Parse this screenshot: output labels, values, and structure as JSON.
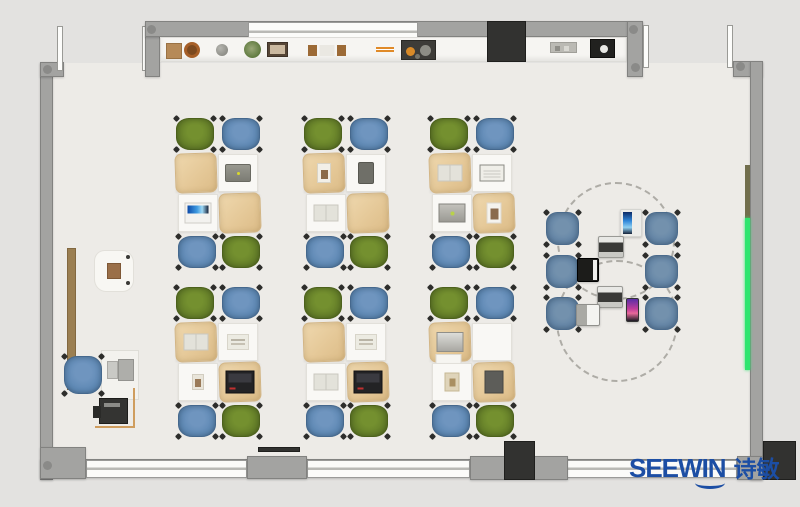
{
  "brand": {
    "name": "SEEWIN",
    "cjk": "诗敏",
    "color": "#1c4ea4"
  },
  "palette": {
    "floor": "#edebe7",
    "outside": "#e3e2e0",
    "wall": "#a3a3a1",
    "window": "#fbfbf9",
    "chair_green": "#637d28",
    "chair_blue": "#5c87b3",
    "chair_steel": "#6183a5",
    "desk_cover_tan": "#e8cfa2",
    "board_green": "#2fe56f",
    "board_olive": "#716e4c"
  },
  "clusters": [
    {
      "id": "row1-col1",
      "x": 176,
      "y": 118,
      "chairs": [
        "green",
        "blue",
        "blue",
        "green"
      ],
      "desks": [
        {
          "cover": "tan",
          "item": "none"
        },
        {
          "cover": "white",
          "item": "tablet-gray"
        },
        {
          "cover": "white",
          "item": "laptop-blue"
        },
        {
          "cover": "tan",
          "item": "none"
        }
      ]
    },
    {
      "id": "row1-col2",
      "x": 304,
      "y": 118,
      "chairs": [
        "green",
        "blue",
        "blue",
        "green"
      ],
      "desks": [
        {
          "cover": "tan",
          "item": "book-white"
        },
        {
          "cover": "white",
          "item": "tablet-dark"
        },
        {
          "cover": "white",
          "item": "open-book"
        },
        {
          "cover": "tan",
          "item": "none"
        }
      ]
    },
    {
      "id": "row1-col3",
      "x": 430,
      "y": 118,
      "chairs": [
        "green",
        "blue",
        "blue",
        "green"
      ],
      "desks": [
        {
          "cover": "tan",
          "item": "open-book"
        },
        {
          "cover": "white",
          "item": "notebook"
        },
        {
          "cover": "white",
          "item": "laptop-gray"
        },
        {
          "cover": "tan",
          "item": "picture"
        }
      ]
    },
    {
      "id": "row2-col1",
      "x": 176,
      "y": 287,
      "chairs": [
        "green",
        "blue",
        "blue",
        "green"
      ],
      "desks": [
        {
          "cover": "tan",
          "item": "open-book"
        },
        {
          "cover": "white",
          "item": "papers"
        },
        {
          "cover": "white",
          "item": "card"
        },
        {
          "cover": "tan",
          "item": "laptop-dark"
        }
      ]
    },
    {
      "id": "row2-col2",
      "x": 304,
      "y": 287,
      "chairs": [
        "green",
        "blue",
        "blue",
        "green"
      ],
      "desks": [
        {
          "cover": "tan",
          "item": "none"
        },
        {
          "cover": "white",
          "item": "papers"
        },
        {
          "cover": "white",
          "item": "open-book"
        },
        {
          "cover": "tan",
          "item": "laptop-dark"
        }
      ]
    },
    {
      "id": "row2-col3",
      "x": 430,
      "y": 287,
      "chairs": [
        "green",
        "blue",
        "blue",
        "green"
      ],
      "desks": [
        {
          "cover": "tan",
          "item": "laptop-silver"
        },
        {
          "cover": "white",
          "item": "none"
        },
        {
          "cover": "white",
          "item": "bag"
        },
        {
          "cover": "tan",
          "item": "book-dark"
        }
      ]
    }
  ],
  "collab": {
    "circles": [
      {
        "x": 557,
        "y": 182,
        "d": 118
      },
      {
        "x": 556,
        "y": 260,
        "d": 122
      }
    ],
    "chairs": [
      {
        "x": 546,
        "y": 212
      },
      {
        "x": 645,
        "y": 212
      },
      {
        "x": 546,
        "y": 255
      },
      {
        "x": 645,
        "y": 255
      },
      {
        "x": 546,
        "y": 297
      },
      {
        "x": 645,
        "y": 297
      }
    ],
    "devices": [
      {
        "kind": "tablet-stand",
        "x": 620,
        "y": 209,
        "w": 22,
        "h": 28
      },
      {
        "kind": "laptop-gray",
        "x": 598,
        "y": 236,
        "w": 26,
        "h": 22
      },
      {
        "kind": "laptop-black",
        "x": 577,
        "y": 258,
        "w": 22,
        "h": 24
      },
      {
        "kind": "laptop-gray",
        "x": 597,
        "y": 286,
        "w": 26,
        "h": 22
      },
      {
        "kind": "laptop-white",
        "x": 576,
        "y": 304,
        "w": 24,
        "h": 22
      },
      {
        "kind": "tablet-color",
        "x": 626,
        "y": 298,
        "w": 13,
        "h": 24
      }
    ]
  },
  "counter": {
    "items": [
      {
        "kind": "basket",
        "x": 166
      },
      {
        "kind": "sphere",
        "x": 216
      },
      {
        "kind": "plant",
        "x": 244
      },
      {
        "kind": "frame",
        "x": 267
      },
      {
        "kind": "trays",
        "x": 308
      },
      {
        "kind": "bars",
        "x": 376
      },
      {
        "kind": "toolbox",
        "x": 401
      },
      {
        "kind": "tray",
        "x": 550
      },
      {
        "kind": "device",
        "x": 590
      }
    ]
  },
  "teacher": {
    "side_table": {
      "x": 94,
      "y": 250,
      "w": 40,
      "h": 42
    },
    "door": {
      "x": 67,
      "y": 248,
      "w": 9,
      "h": 142
    },
    "desk": {
      "x": 101,
      "y": 350,
      "w": 38,
      "h": 50
    },
    "chair": {
      "x": 64,
      "y": 356,
      "w": 38,
      "h": 38
    },
    "printer_table": {
      "x": 95,
      "y": 388,
      "w": 40,
      "h": 40
    },
    "printer": {
      "x": 99,
      "y": 398,
      "w": 29,
      "h": 26
    }
  },
  "boards": {
    "olive": {
      "x": 745,
      "y": 165,
      "w": 5,
      "h": 53
    },
    "green": {
      "x": 745,
      "y": 218,
      "w": 5,
      "h": 152
    }
  }
}
